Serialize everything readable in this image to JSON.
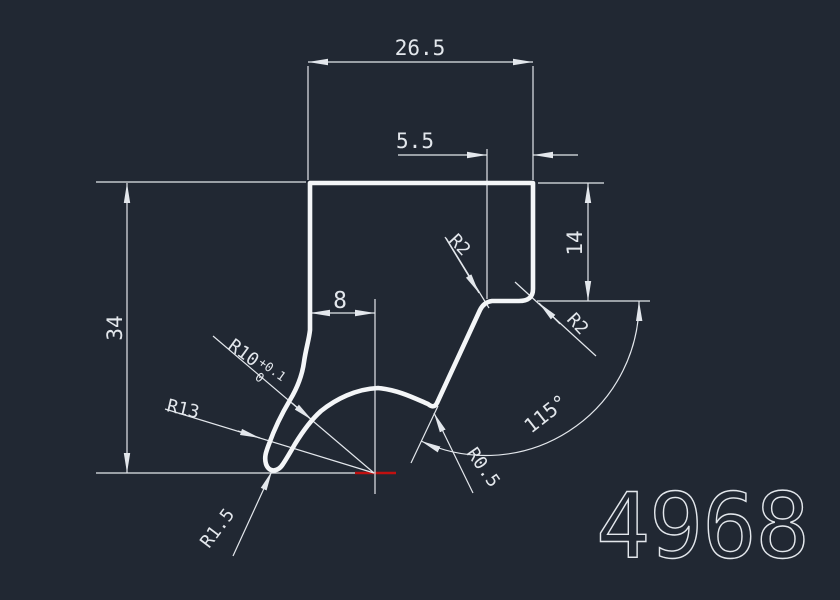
{
  "canvas": {
    "background_color": "#212833",
    "line_color": "#e3e7ec",
    "profile_color": "#f4f6f8",
    "highlight_color": "#c01010"
  },
  "labels": {
    "dim_width_top": "26.5",
    "dim_width_step": "5.5",
    "dim_width_groove": "8",
    "dim_height_left": "34",
    "dim_height_right": "14",
    "dim_angle": "115°",
    "radius_corner_left": "R2",
    "radius_corner_right": "R2",
    "radius_inner": "R10",
    "radius_inner_tol_upper": "+0.1",
    "radius_inner_tol_lower": "0",
    "radius_outer": "R13",
    "radius_tip": "R1.5",
    "radius_notch": "R0.5",
    "part_number": "4968"
  }
}
